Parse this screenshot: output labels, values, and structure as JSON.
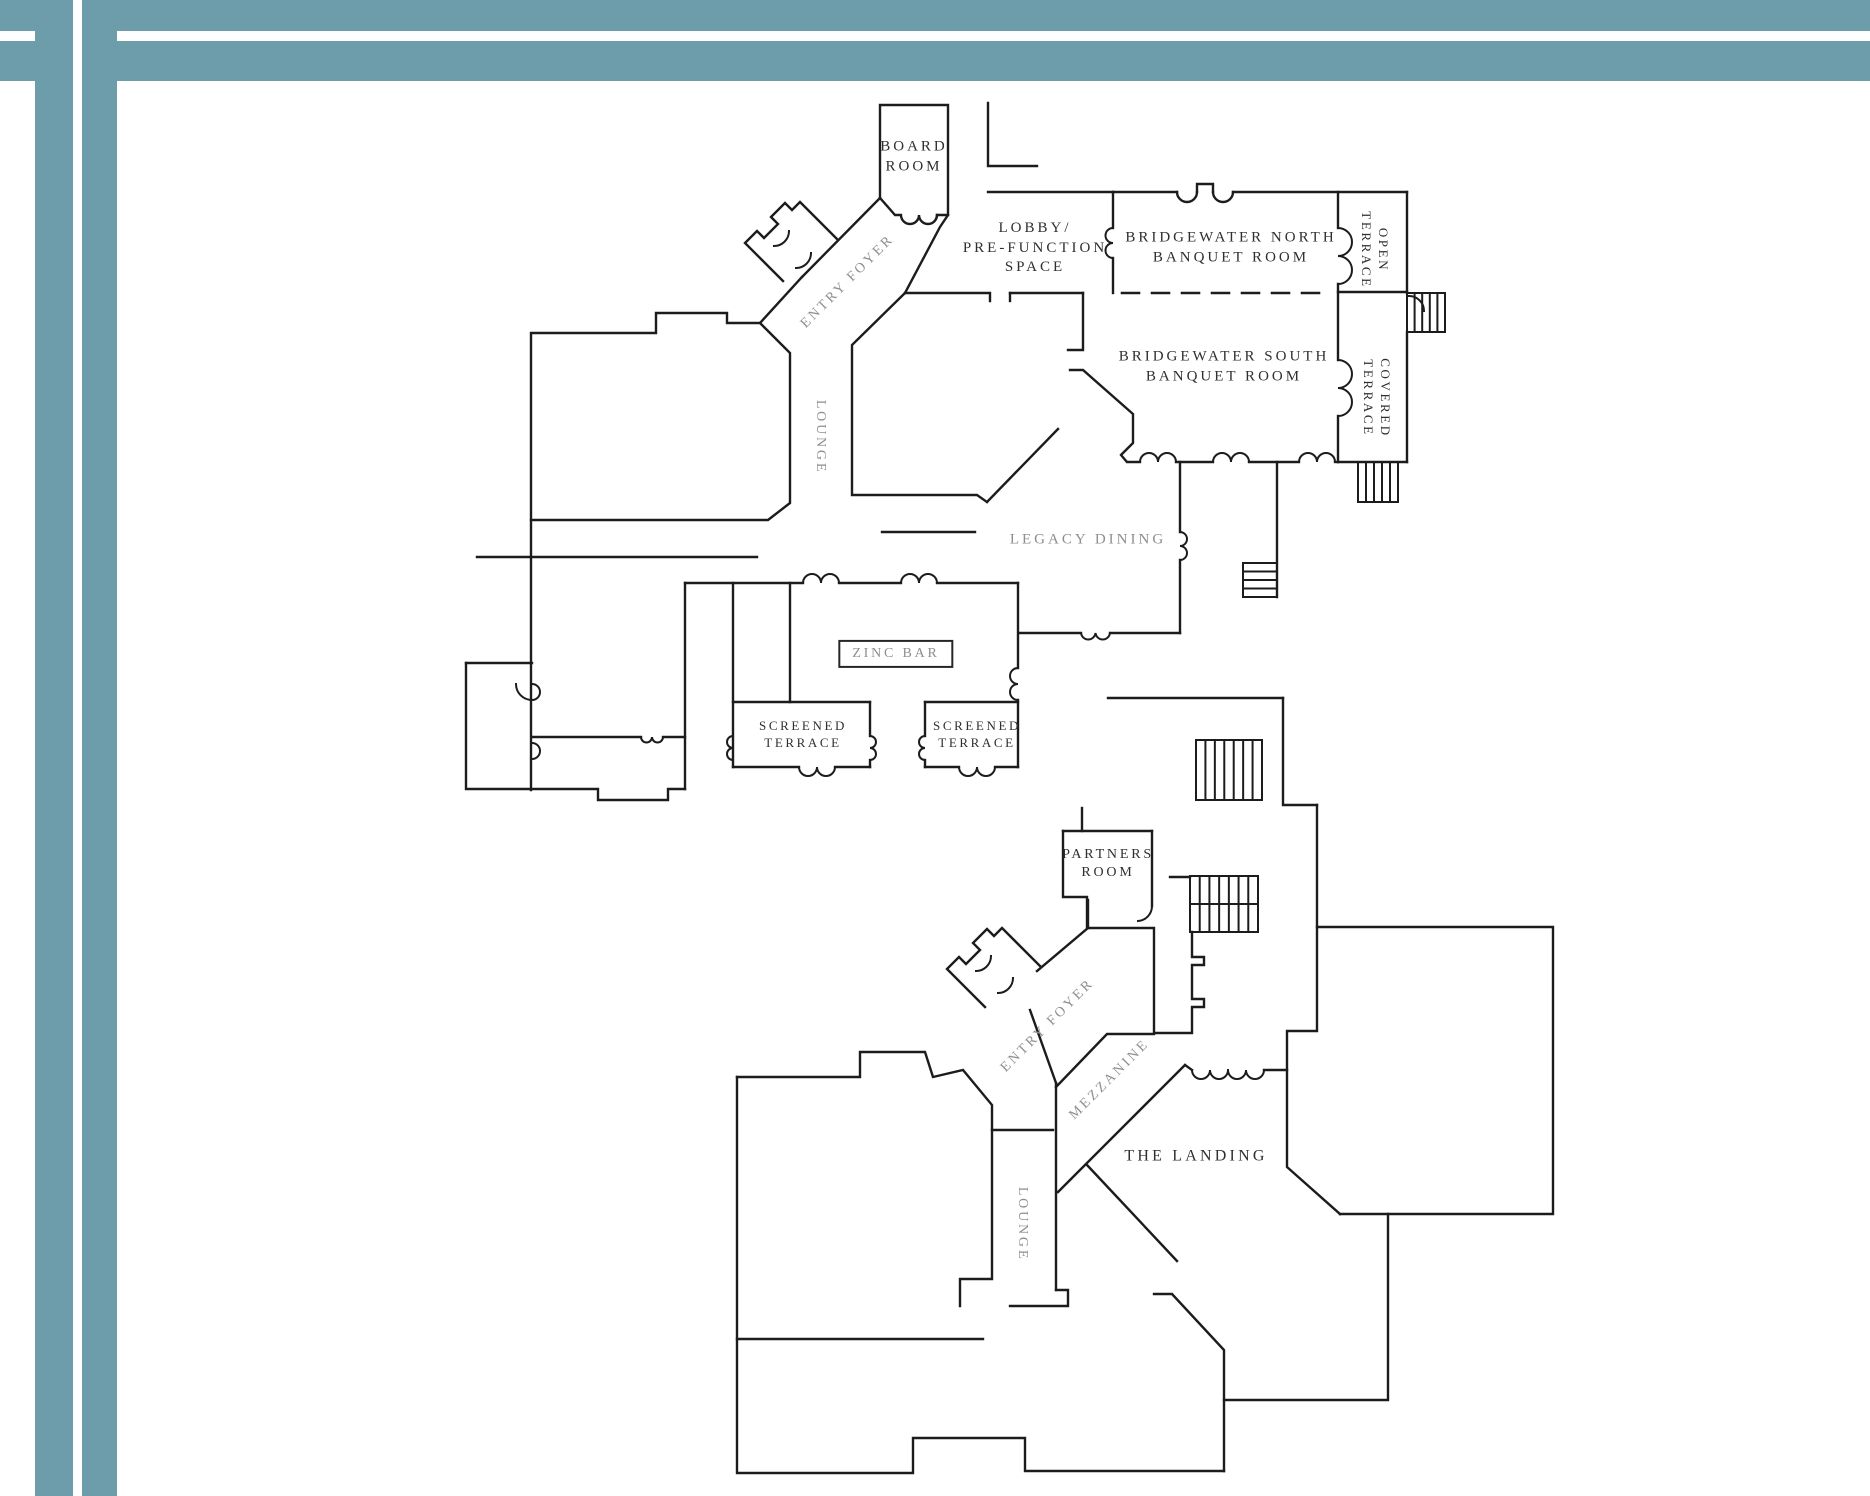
{
  "document": {
    "type": "architectural-floor-plan-sheet",
    "background": "#ffffff"
  },
  "frame": {
    "color": "#6d9cab"
  },
  "palette": {
    "wall": "#1c1c1c",
    "dark_label": "#2f2f2f",
    "muted_label": "#8e8e8e"
  },
  "plans": [
    {
      "id": "main-level",
      "labels": [
        {
          "id": "board-room",
          "lines": [
            "BOARD",
            "ROOM"
          ],
          "x": 914,
          "y": 157,
          "rotation": 0,
          "tone": "dark",
          "size": 15
        },
        {
          "id": "lobby-pre-function-space",
          "lines": [
            "LOBBY/",
            "PRE-FUNCTION",
            "SPACE"
          ],
          "x": 1035,
          "y": 248,
          "rotation": 0,
          "tone": "dark",
          "size": 15
        },
        {
          "id": "bridgewater-north-banquet-room",
          "lines": [
            "BRIDGEWATER NORTH",
            "BANQUET ROOM"
          ],
          "x": 1231,
          "y": 248,
          "rotation": 0,
          "tone": "dark",
          "size": 15
        },
        {
          "id": "open-terrace",
          "lines": [
            "OPEN",
            "TERRACE"
          ],
          "x": 1374,
          "y": 250,
          "rotation": 90,
          "tone": "dark",
          "size": 13
        },
        {
          "id": "bridgewater-south-banquet-room",
          "lines": [
            "BRIDGEWATER SOUTH",
            "BANQUET ROOM"
          ],
          "x": 1224,
          "y": 367,
          "rotation": 0,
          "tone": "dark",
          "size": 15
        },
        {
          "id": "covered-terrace",
          "lines": [
            "COVERED",
            "TERRACE"
          ],
          "x": 1376,
          "y": 398,
          "rotation": 90,
          "tone": "dark",
          "size": 13
        },
        {
          "id": "entry-foyer-main",
          "lines": [
            "ENTRY FOYER"
          ],
          "x": 848,
          "y": 282,
          "rotation": -45,
          "tone": "muted",
          "size": 14
        },
        {
          "id": "lounge-main",
          "lines": [
            "LOUNGE"
          ],
          "x": 820,
          "y": 437,
          "rotation": 90,
          "tone": "muted",
          "size": 14
        },
        {
          "id": "legacy-dining",
          "lines": [
            "LEGACY DINING"
          ],
          "x": 1088,
          "y": 540,
          "rotation": 0,
          "tone": "muted",
          "size": 15
        },
        {
          "id": "zinc-bar",
          "lines": [
            "ZINC BAR"
          ],
          "x": 896,
          "y": 654,
          "rotation": 0,
          "tone": "muted",
          "size": 14,
          "boxed": true
        },
        {
          "id": "screened-terrace-west",
          "lines": [
            "SCREENED",
            "TERRACE"
          ],
          "x": 803,
          "y": 735,
          "rotation": 0,
          "tone": "dark",
          "size": 13
        },
        {
          "id": "screened-terrace-east",
          "lines": [
            "SCREENED",
            "TERRACE"
          ],
          "x": 977,
          "y": 735,
          "rotation": 0,
          "tone": "dark",
          "size": 13
        }
      ]
    },
    {
      "id": "mezzanine-level",
      "labels": [
        {
          "id": "partners-room",
          "lines": [
            "PARTNERS",
            "ROOM"
          ],
          "x": 1108,
          "y": 864,
          "rotation": 0,
          "tone": "dark",
          "size": 14
        },
        {
          "id": "entry-foyer-mezzanine",
          "lines": [
            "ENTRY FOYER"
          ],
          "x": 1048,
          "y": 1026,
          "rotation": -45,
          "tone": "muted",
          "size": 14
        },
        {
          "id": "mezzanine",
          "lines": [
            "MEZZANINE"
          ],
          "x": 1110,
          "y": 1080,
          "rotation": -45,
          "tone": "muted",
          "size": 14
        },
        {
          "id": "the-landing",
          "lines": [
            "THE LANDING"
          ],
          "x": 1196,
          "y": 1157,
          "rotation": 0,
          "tone": "dark",
          "size": 16
        },
        {
          "id": "lounge-mezzanine",
          "lines": [
            "LOUNGE"
          ],
          "x": 1022,
          "y": 1224,
          "rotation": 90,
          "tone": "muted",
          "size": 14
        }
      ]
    }
  ]
}
